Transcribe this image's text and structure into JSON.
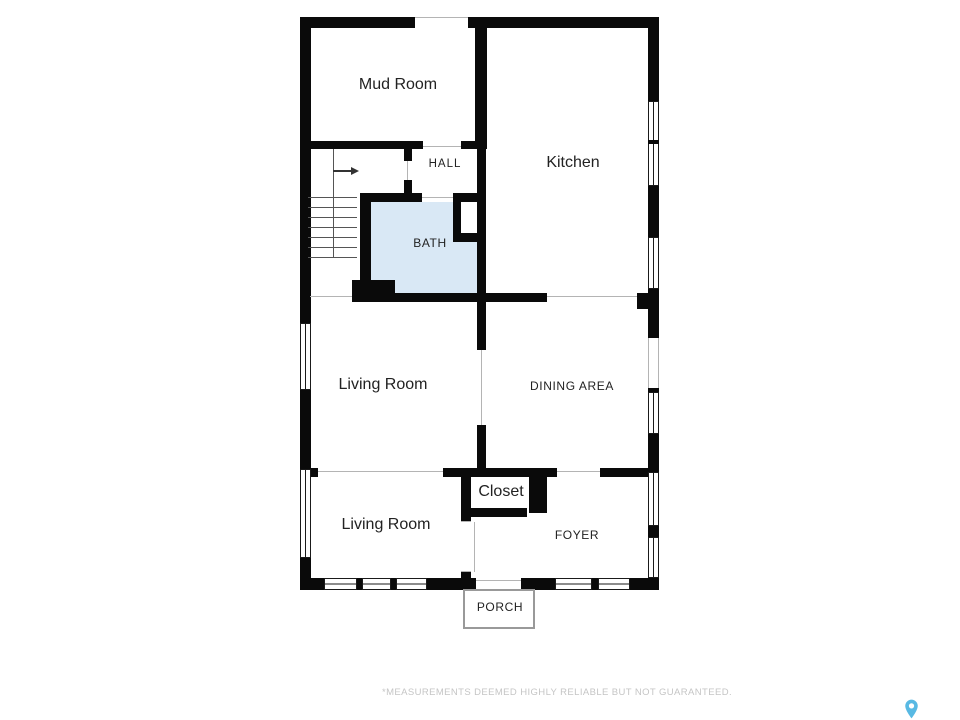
{
  "floorplan": {
    "rooms": {
      "mud_room": {
        "label": "Mud Room"
      },
      "hall": {
        "label": "HALL"
      },
      "kitchen": {
        "label": "Kitchen"
      },
      "bath": {
        "label": "BATH"
      },
      "living_room_upper": {
        "label": "Living Room"
      },
      "dining_area": {
        "label": "DINING AREA"
      },
      "living_room_lower": {
        "label": "Living Room"
      },
      "closet": {
        "label": "Closet"
      },
      "foyer": {
        "label": "FOYER"
      },
      "porch": {
        "label": "PORCH"
      }
    },
    "stairs": {
      "treads": 7,
      "direction_arrow": "right"
    },
    "colors": {
      "wall": "#0a0a0a",
      "bath_fill": "#d9e8f5",
      "label": "#222222",
      "thin": "#b4b4b4",
      "tread": "#555555",
      "porch_line": "#999999",
      "disclaimer": "#c5c5c5",
      "pin": "#58b9e3"
    }
  },
  "footer": {
    "disclaimer": "*MEASUREMENTS DEEMED HIGHLY RELIABLE BUT NOT GUARANTEED."
  }
}
